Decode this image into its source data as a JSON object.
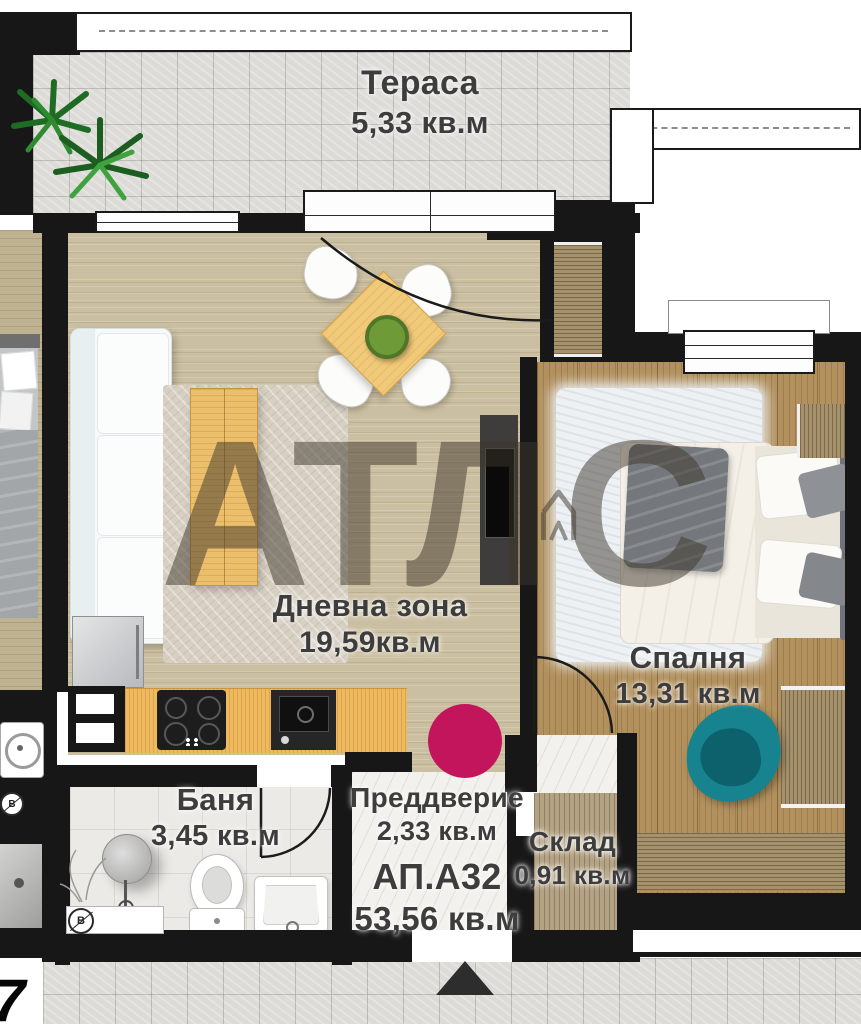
{
  "watermark": {
    "brand": "АТЛАС",
    "left": "АТЛ",
    "right": "С",
    "color": "#3e362c"
  },
  "apartment": {
    "code": "АП.А32",
    "total_area": "53,56 кв.м"
  },
  "rooms": {
    "terrace": {
      "name": "Тераса",
      "area": "5,33 кв.м"
    },
    "living": {
      "name": "Дневна зона",
      "area": "19,59кв.м"
    },
    "bedroom": {
      "name": "Спалня",
      "area": "13,31 кв.м"
    },
    "bathroom": {
      "name": "Баня",
      "area": "3,45 кв.м"
    },
    "vestibule": {
      "name": "Преддверие",
      "area": "2,33 кв.м"
    },
    "storage": {
      "name": "Склад",
      "area": "0,91 кв.м"
    }
  },
  "annotations": {
    "neighbor_unit_digit": "7",
    "water_meter_symbol": "В"
  },
  "markers": {
    "entrance_dot_color": "#c3155b",
    "entrance_arrow_color": "#2d2d2d"
  },
  "colors": {
    "wall": "#171717",
    "living_floor": "#cbbfa1",
    "bedroom_floor": "#b2915e",
    "terrace_tile": "#dcdbd7",
    "kitchen_counter": "#eeb95f",
    "accent_chair_teal": "#17838e",
    "label_text": "#3d3d3d"
  }
}
